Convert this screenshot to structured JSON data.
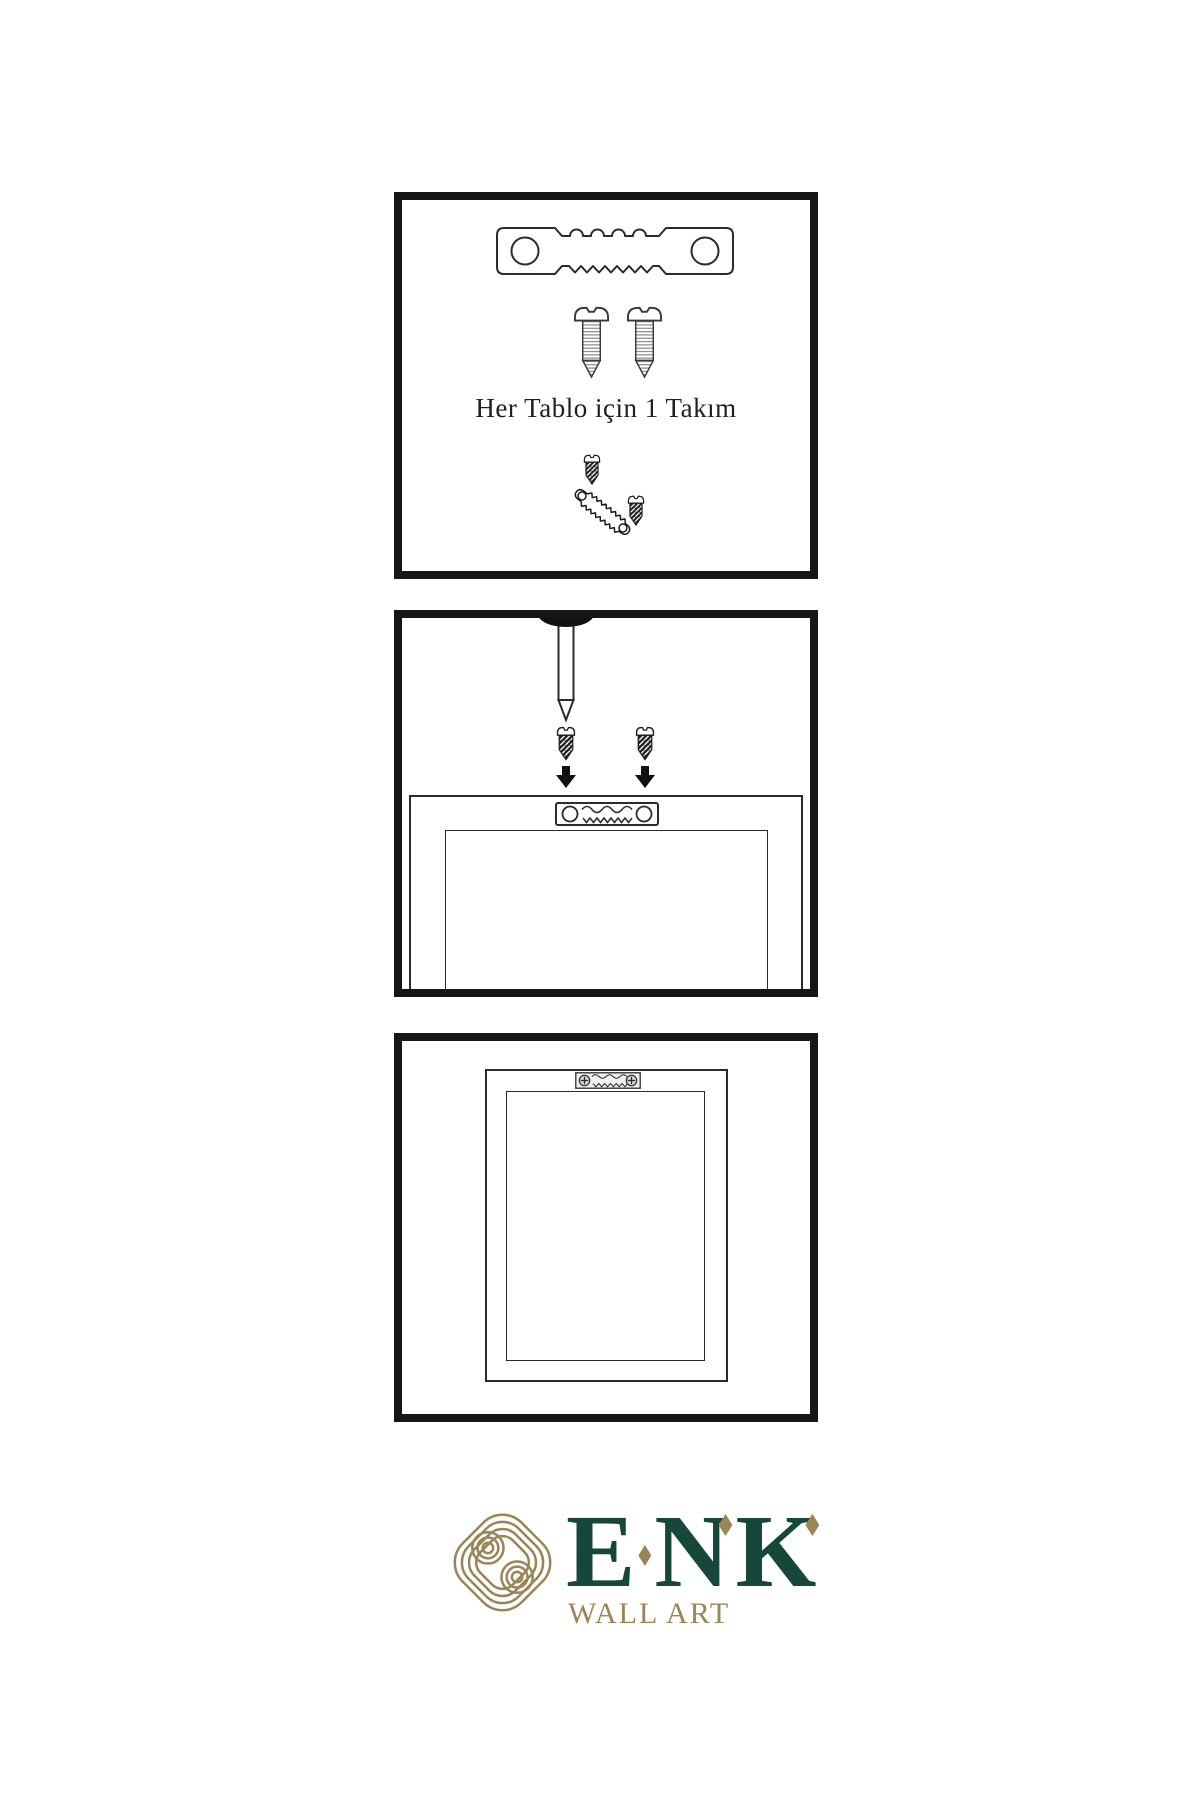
{
  "colors": {
    "ink": "#1f1f1f",
    "line": "#2b2b2b",
    "frame_border": "#161616",
    "green": "#17463B",
    "gold": "#9A8558"
  },
  "steps": {
    "step1": {
      "caption": "Her Tablo için 1 Takım",
      "icons": [
        "sawtooth-hanger-icon",
        "screw-icon",
        "screw-icon",
        "screw-into-hanger-icon"
      ]
    },
    "step2": {
      "icons": [
        "nail-icon",
        "screw-icon",
        "screw-icon",
        "arrow-down-icon",
        "arrow-down-icon",
        "frame-back-with-sawtooth-hanger-icon"
      ]
    },
    "step3": {
      "icons": [
        "hung-frame-with-sawtooth-hanger-icon"
      ]
    }
  },
  "brand": {
    "letters": [
      "E",
      "N",
      "K"
    ],
    "tagline": "WALL ART",
    "logo_icon": "knot-logo-icon"
  }
}
